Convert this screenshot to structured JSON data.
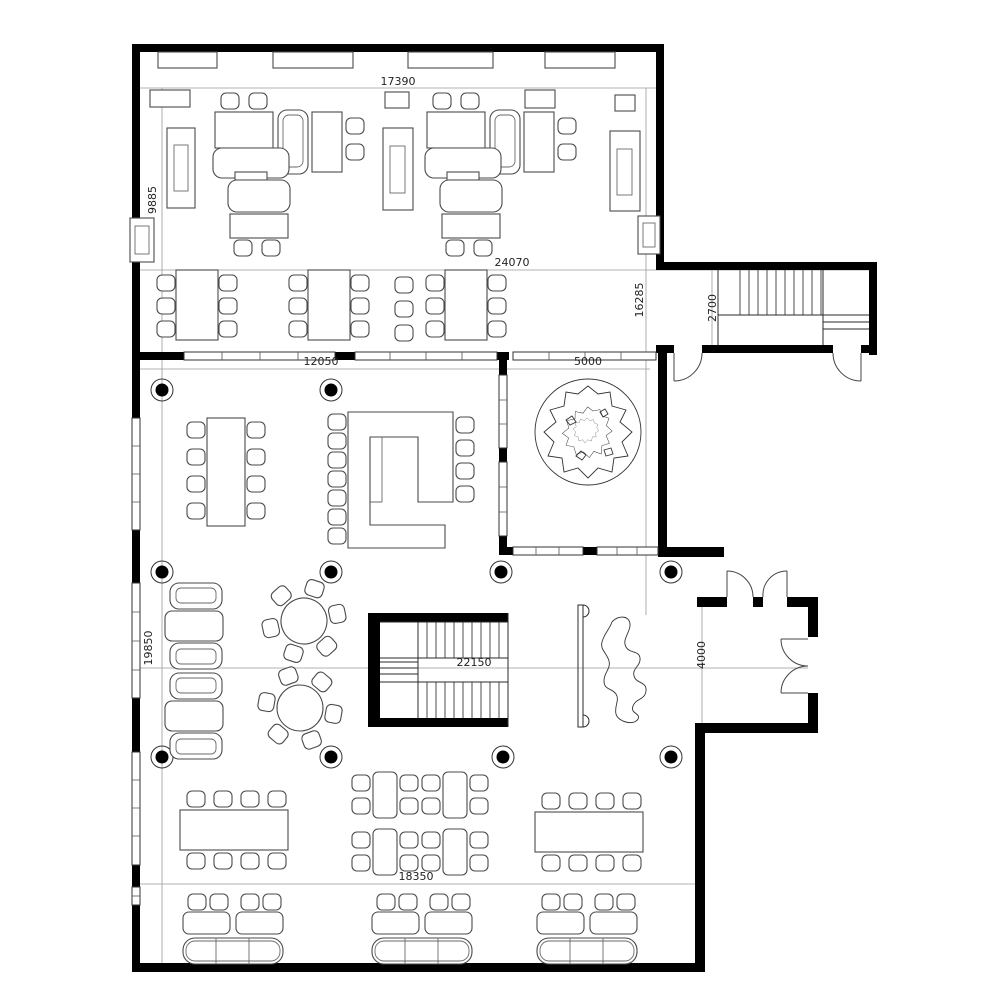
{
  "drawing": {
    "kind": "architectural floor plan",
    "colors": {
      "walls": "#000000",
      "furniture_lines": "#4a4a4a",
      "grid_lines": "#9a9a9a",
      "background": "#ffffff",
      "text": "#222222"
    }
  },
  "dimensions": {
    "top_width": "17390",
    "upper_left_height": "9885",
    "middle_width": "24070",
    "upper_right_height": "16285",
    "stair_corridor_width": "2700",
    "courtyard_width": "5000",
    "meeting_room_width": "12050",
    "lower_left_height": "19850",
    "central_width": "22150",
    "entrance_height": "4000",
    "dining_width": "18350"
  }
}
